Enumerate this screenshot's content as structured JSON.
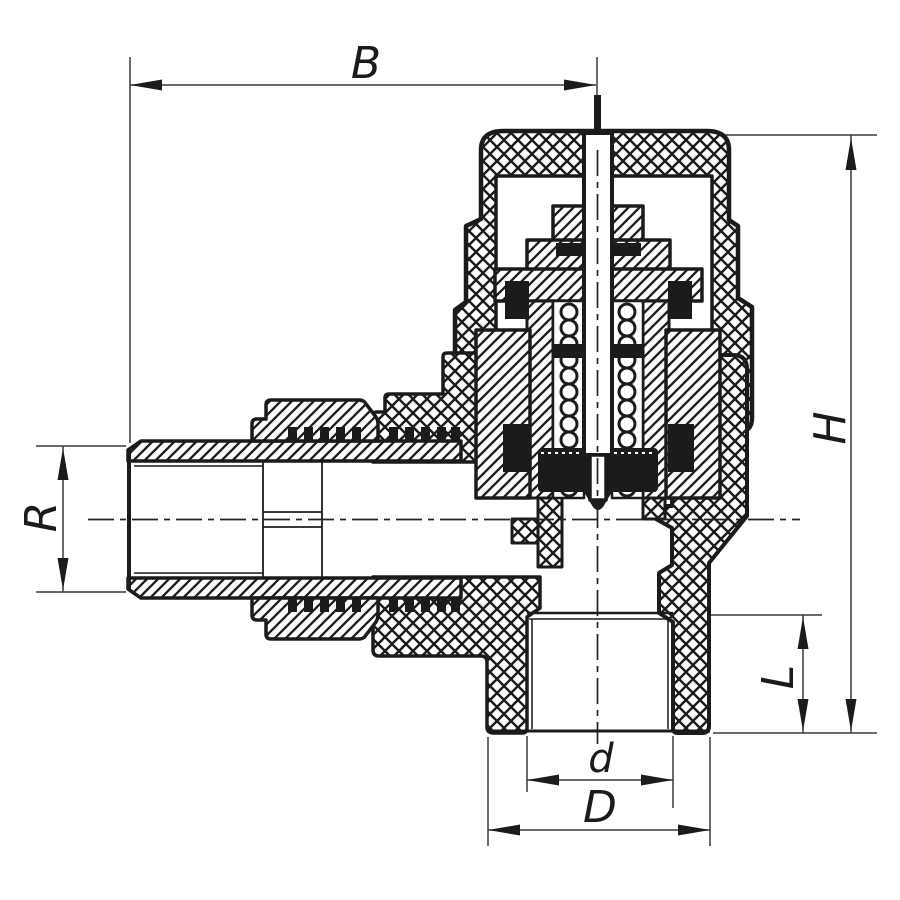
{
  "drawing": {
    "subject": "Angle radiator valve — sectional technical drawing",
    "ink_color": "#1b1b1b",
    "paper_color": "#ffffff",
    "dimensions": {
      "B": {
        "label": "B",
        "orientation": "horizontal",
        "position": "top"
      },
      "H": {
        "label": "H",
        "orientation": "vertical",
        "position": "right"
      },
      "R": {
        "label": "R",
        "orientation": "vertical",
        "position": "left"
      },
      "L": {
        "label": "L",
        "orientation": "vertical",
        "position": "lower-right"
      },
      "d": {
        "label": "d",
        "orientation": "horizontal",
        "position": "bottom-inner"
      },
      "D": {
        "label": "D",
        "orientation": "horizontal",
        "position": "bottom-outer"
      }
    },
    "components": [
      "thermostatic-cap",
      "valve-stem",
      "spring",
      "bonnet",
      "union-nut",
      "male-tailpiece",
      "valve-body",
      "outlet-socket"
    ]
  }
}
